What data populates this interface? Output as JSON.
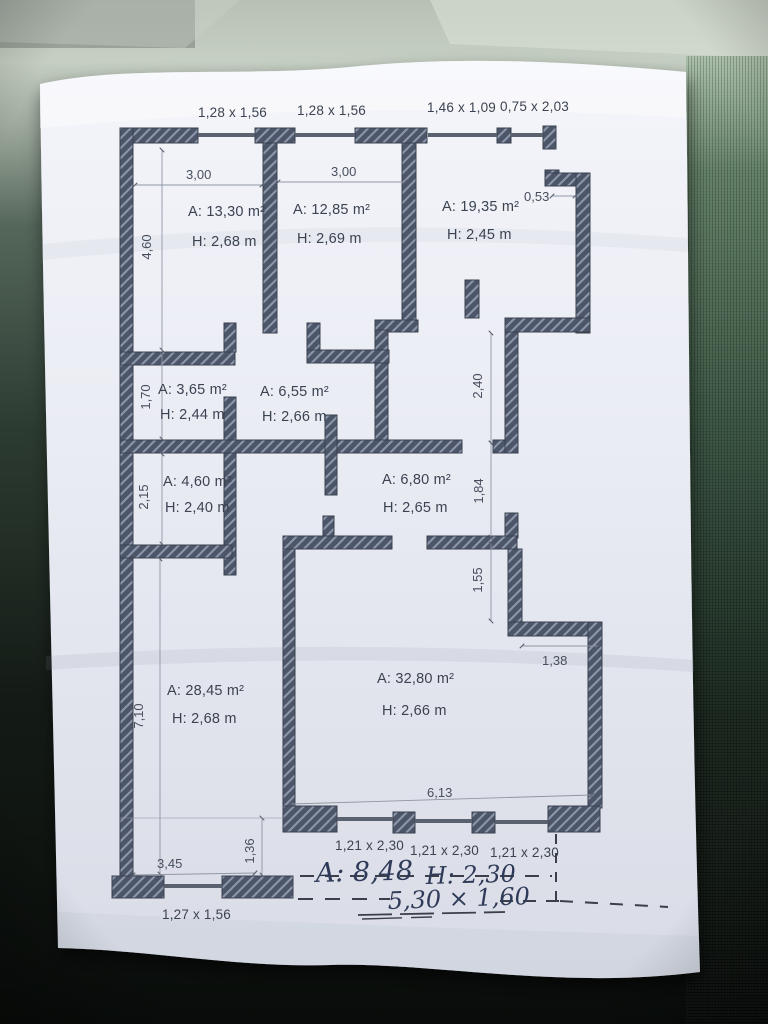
{
  "plan": {
    "top_openings": [
      "1,28 x 1,56",
      "1,28 x 1,56",
      "1,46 x 1,09",
      "0,75 x 2,03"
    ],
    "bottom_openings": [
      "1,21 x 2,30",
      "1,21 x 2,30",
      "1,21 x 2,30"
    ],
    "bottom_left_opening": "1,27 x 1,56",
    "rooms": [
      {
        "area": "A: 13,30 m²",
        "height": "H: 2,68 m"
      },
      {
        "area": "A: 12,85 m²",
        "height": "H: 2,69 m"
      },
      {
        "area": "A: 19,35 m²",
        "height": "H: 2,45 m"
      },
      {
        "area": "A: 3,65 m²",
        "height": "H: 2,44 m"
      },
      {
        "area": "A: 6,55 m²",
        "height": "H: 2,66 m"
      },
      {
        "area": "A: 4,60 m²",
        "height": "H: 2,40 m"
      },
      {
        "area": "A: 6,80 m²",
        "height": "H: 2,65 m"
      },
      {
        "area": "A: 28,45 m²",
        "height": "H: 2,68 m"
      },
      {
        "area": "A: 32,80 m²",
        "height": "H: 2,66 m"
      }
    ],
    "dims": {
      "room1_width": "3,00",
      "room2_width": "3,00",
      "left_top": "4,60",
      "top_right_offset": "0,53",
      "left_mid1": "1,70",
      "left_mid2": "2,15",
      "left_bottom": "7,10",
      "right_mid1": "2,40",
      "right_mid2": "1,84",
      "right_mid3": "1,55",
      "right_step_width": "1,38",
      "bottom_width": "6,13",
      "bottom_left_width": "3,45",
      "bottom_left_height": "1,36"
    },
    "handwriting": {
      "area_note": "A: 8,48",
      "height_note": "H: 2,30",
      "size_note": "5,30 × 1,60"
    }
  }
}
